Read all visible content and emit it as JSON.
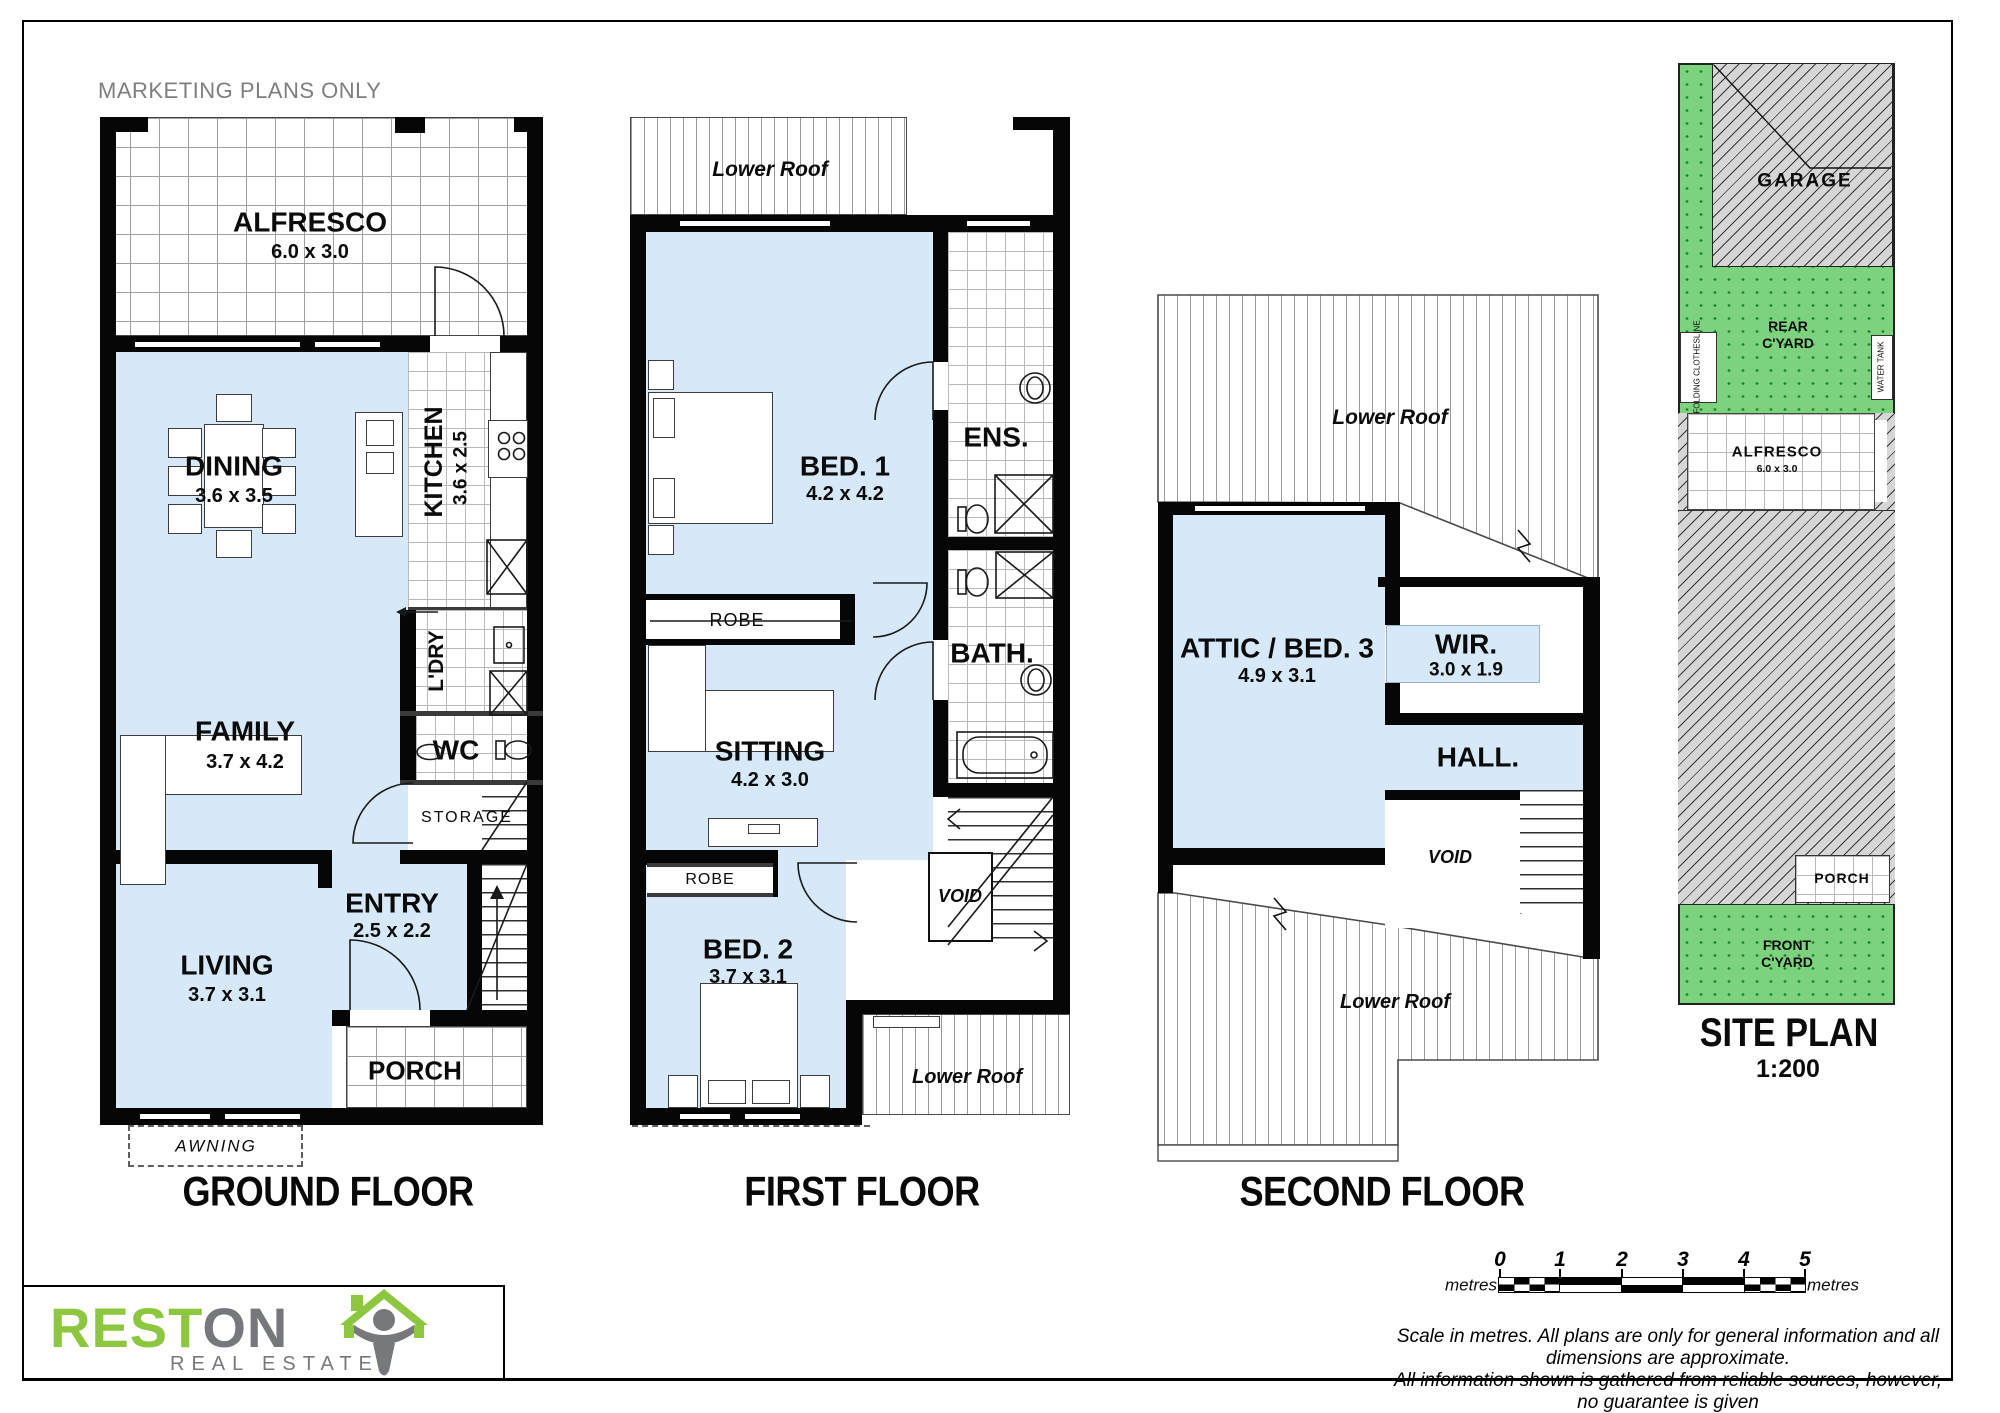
{
  "watermark": "MARKETING PLANS ONLY",
  "floors": {
    "ground": {
      "title": "GROUND FLOOR",
      "alfresco": {
        "name": "ALFRESCO",
        "dims": "6.0 x 3.0"
      },
      "dining": {
        "name": "DINING",
        "dims": "3.6 x 3.5"
      },
      "kitchen": {
        "name": "KITCHEN",
        "dims": "3.6 x 2.5"
      },
      "ldry": {
        "name": "L'DRY"
      },
      "wc": {
        "name": "WC"
      },
      "storage": {
        "name": "STORAGE"
      },
      "family": {
        "name": "FAMILY",
        "dims": "3.7 x 4.2"
      },
      "entry": {
        "name": "ENTRY",
        "dims": "2.5 x 2.2"
      },
      "living": {
        "name": "LIVING",
        "dims": "3.7 x 3.1"
      },
      "porch": {
        "name": "PORCH"
      },
      "awning": {
        "name": "AWNING"
      }
    },
    "first": {
      "title": "FIRST FLOOR",
      "roof_top": {
        "name": "Lower Roof"
      },
      "bed1": {
        "name": "BED. 1",
        "dims": "4.2 x 4.2"
      },
      "ens": {
        "name": "ENS."
      },
      "robe1": {
        "name": "ROBE"
      },
      "bath": {
        "name": "BATH."
      },
      "sitting": {
        "name": "SITTING",
        "dims": "4.2 x 3.0"
      },
      "robe2": {
        "name": "ROBE"
      },
      "bed2": {
        "name": "BED. 2",
        "dims": "3.7 x 3.1"
      },
      "void": {
        "name": "VOID"
      },
      "roof_bottom": {
        "name": "Lower Roof"
      }
    },
    "second": {
      "title": "SECOND FLOOR",
      "roof_top": {
        "name": "Lower Roof"
      },
      "attic": {
        "name": "ATTIC / BED. 3",
        "dims": "4.9 x 3.1"
      },
      "wir": {
        "name": "WIR.",
        "dims": "3.0 x 1.9"
      },
      "hall": {
        "name": "HALL."
      },
      "void": {
        "name": "VOID"
      },
      "roof_bottom": {
        "name": "Lower Roof"
      }
    }
  },
  "site_plan": {
    "title": "SITE PLAN",
    "scale": "1:200",
    "garage": "GARAGE",
    "rear_yard_line1": "REAR",
    "rear_yard_line2": "C'YARD",
    "folding_clothesline": "FOLDING CLOTHESLINE",
    "water_tank": "WATER TANK",
    "alfresco": {
      "name": "ALFRESCO",
      "dims": "6.0 x 3.0"
    },
    "porch": "PORCH",
    "front_yard_line1": "FRONT",
    "front_yard_line2": "C'YARD"
  },
  "logo": {
    "brand_green": "REST",
    "brand_grey": "ON",
    "tagline": "REAL ESTATE"
  },
  "scale_bar": {
    "ticks": [
      "0",
      "1",
      "2",
      "3",
      "4",
      "5"
    ],
    "unit_left": "metres",
    "unit_right": "metres"
  },
  "disclaimer": {
    "line1": "Scale in metres. All plans are only for general information and all dimensions are approximate.",
    "line2": "All information shown is gathered from reliable sources, however, no guarantee is given",
    "line3": "regarding accuracy and all interested parties should rely on their own enquiries."
  },
  "colors": {
    "room_fill": "#d7e9f8",
    "yard_green": "#7dd37d",
    "hatch_grey": "#d6d6d6",
    "wall_black": "#060606",
    "brand_green": "#8dc63f",
    "brand_grey": "#77787b"
  }
}
